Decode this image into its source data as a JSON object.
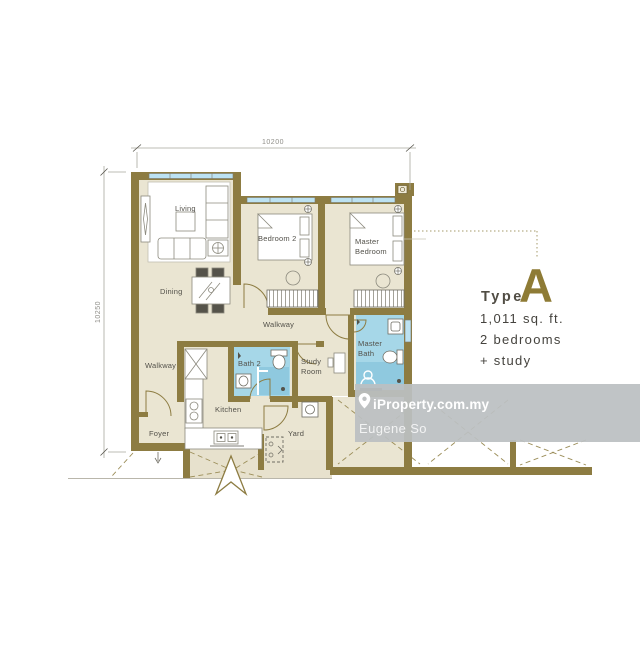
{
  "plan": {
    "dimensions": {
      "width_label": "10200",
      "height_label": "10250"
    },
    "labels": {
      "living": "Living",
      "dining": "Dining",
      "bedroom2": "Bedroom 2",
      "master_line1": "Master",
      "master_line2": "Bedroom",
      "walkway_mid": "Walkway",
      "walkway_left": "Walkway",
      "bath2": "Bath 2",
      "study_line1": "Study",
      "study_line2": "Room",
      "master_bath_line1": "Master",
      "master_bath_line2": "Bath",
      "kitchen": "Kitchen",
      "foyer": "Foyer",
      "yard": "Yard"
    }
  },
  "unit_info": {
    "type_prefix": "Type",
    "type_letter": "A",
    "area": "1,011 sq. ft.",
    "bedrooms": "2 bedrooms",
    "extra": "+ study"
  },
  "watermark": {
    "brand": "iProperty.com.my",
    "agent": "Eugene So"
  },
  "icons": {
    "watermark_pin": "map-pin-icon"
  },
  "colors": {
    "wall": "#8d7c42",
    "floor": "#eae5d2",
    "bath_floor": "#a6d7e8",
    "shower_floor": "#8fc9df",
    "window": "#bce2f2",
    "accent_gold": "#8e7b35",
    "watermark_bg": "#bbbfc2",
    "label_text": "#53514a"
  }
}
